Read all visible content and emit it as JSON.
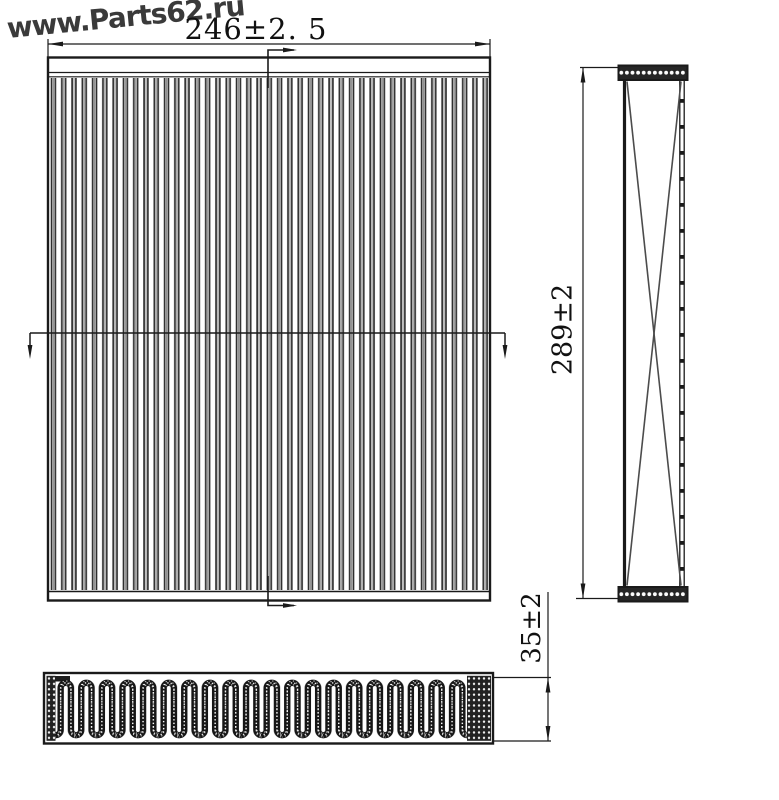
{
  "watermark": {
    "text": "www.Parts62.ru"
  },
  "dimensions": {
    "width": {
      "label": "246±2. 5",
      "value": "246",
      "tolerance": "±2.5"
    },
    "height": {
      "label": "289±2",
      "value": "289",
      "tolerance": "±2"
    },
    "thickness": {
      "label": "35±2",
      "value": "35",
      "tolerance": "±2"
    }
  },
  "colors": {
    "line": "#1a1a1a",
    "watermark": "#3a3a3a",
    "background": "#ffffff"
  }
}
